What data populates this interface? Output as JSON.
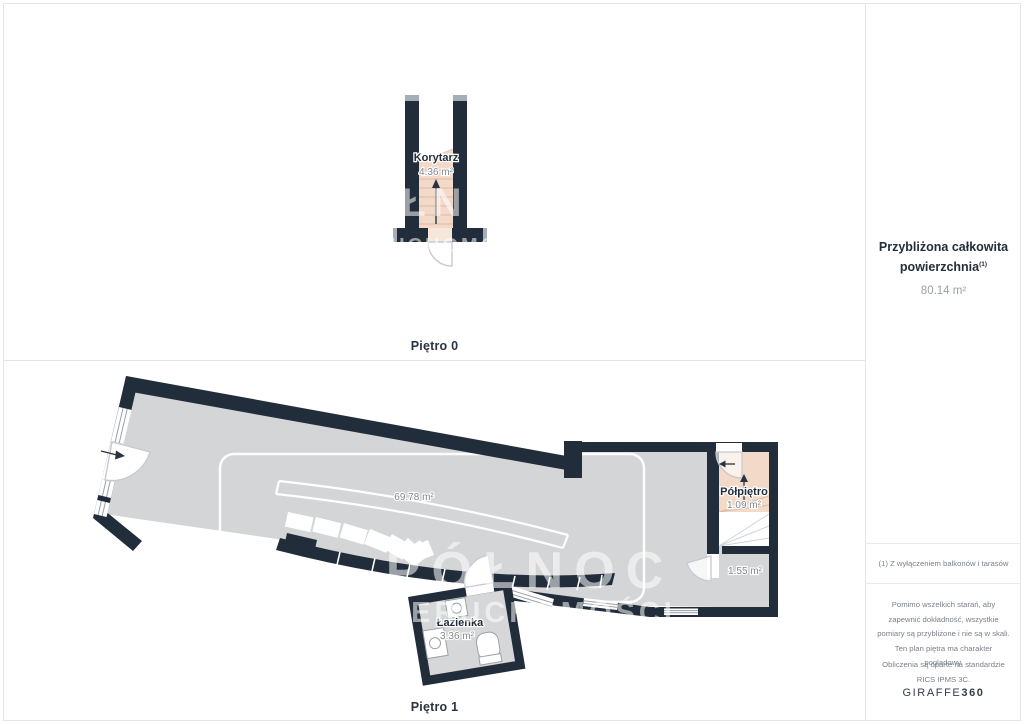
{
  "floor0": {
    "title": "Piętro 0",
    "rooms": [
      {
        "name": "Korytarz",
        "area": "4.36 m²"
      }
    ]
  },
  "floor1": {
    "title": "Piętro 1",
    "main_area": "69.78 m²",
    "rooms": [
      {
        "name": "Półpiętro",
        "area": "1.09 m²"
      },
      {
        "name": "",
        "area": "1.55 m²"
      },
      {
        "name": "Łazienka",
        "area": "3.36 m²"
      }
    ]
  },
  "sidebar": {
    "total_label_line1": "Przybliżona całkowita",
    "total_label_line2": "powierzchnia",
    "total_superscript": "(1)",
    "total_value": "80.14 m²",
    "footnote": "(1) Z wyłączeniem balkonów i tarasów",
    "disclaimer_lines": [
      "Pomimo wszelkich starań, aby",
      "zapewnić dokładność, wszystkie",
      "pomiary są przybliżone i nie są w skali.",
      "Ten plan piętra ma charakter",
      "poglądowy."
    ],
    "standard_lines": [
      "Obliczenia są oparte na standardzie",
      "RICS IPMS 3C."
    ],
    "brand": {
      "name": "GIRAFFE",
      "suffix": "360"
    }
  },
  "watermark": {
    "line1": "PÓŁNOC",
    "line2": "NIERUCHOMOŚCI"
  },
  "colors": {
    "wall": "#222d3b",
    "floor": "#d4d5d7",
    "stairs_accent": "#f2d9c8",
    "label_navy": "#232e3c",
    "label_gray": "#82878f",
    "divider": "#e4e5e7",
    "watermark": "rgba(255,255,255,0.55)"
  }
}
